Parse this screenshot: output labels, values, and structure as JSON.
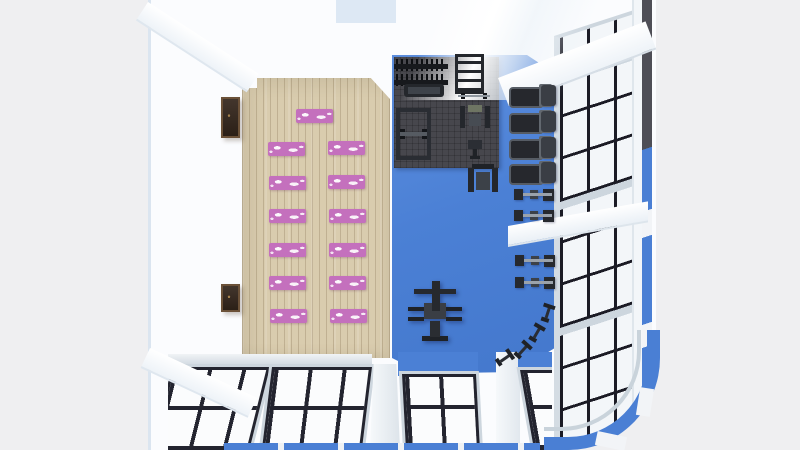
{
  "scene": {
    "title": "Top-down 3D render of a gym interior floor plan",
    "description": "Gym room viewed from above: wooden yoga zone on the left with pink patterned mats, blue cardio and strength zone on the right with a dark rubber free-weight mat, treadmills and ellipticals along a glazed wall, spin bikes in a curved glass corner, window walls with black mullions on the right and bottom, white walls and ceiling beams.",
    "colors": {
      "background": "#efeff1",
      "wall_white": "#fbfcfe",
      "wood_floor": "#d9ccae",
      "blue_floor": "#4b80d5",
      "rubber_mat": "#47474d",
      "yoga_mat_pink": "#c470bd",
      "window_mullion": "#1b1b25",
      "window_pane": "#f6f8fa",
      "window_frame_silver": "#cdd6de",
      "exterior_accent_blue": "#4a7fd4",
      "equipment_dark": "#26292e",
      "frame_brown": "#6b5138"
    },
    "zones": {
      "yoga_area": {
        "floor": "light wood planks",
        "mat_count": 13,
        "mat_layout": "1 instructor mat at front, then 6 rows of 2 mats"
      },
      "free_weight_area": {
        "floor": "dark rubber mat",
        "equipment": [
          "dumbbell rack",
          "storage rack",
          "flat bench",
          "power rack",
          "barbell",
          "shoulder press machine",
          "utility seat"
        ]
      },
      "cardio_area": {
        "floor": "blue",
        "treadmill_count": 4,
        "elliptical_count": 4,
        "spin_bike_count": 4,
        "other": [
          "cable crossover machine",
          "leg press machine"
        ]
      },
      "walls": {
        "wall_art_count": 2,
        "window_walls": [
          "right glazed wall with black grid",
          "bottom glazed wall with black grid",
          "curved glass corner bottom-right"
        ]
      }
    }
  },
  "objects": {
    "yoga_mats": {
      "positions": [
        [
          296,
          109
        ],
        [
          268,
          142
        ],
        [
          328,
          141
        ],
        [
          269,
          176
        ],
        [
          328,
          175
        ],
        [
          269,
          209
        ],
        [
          329,
          209
        ],
        [
          269,
          243
        ],
        [
          329,
          243
        ],
        [
          269,
          276
        ],
        [
          329,
          276
        ],
        [
          270,
          309
        ],
        [
          330,
          309
        ]
      ]
    },
    "treadmills": {
      "positions": [
        [
          509,
          85
        ],
        [
          509,
          111
        ],
        [
          509,
          137
        ],
        [
          509,
          162
        ]
      ]
    },
    "ellipticals": {
      "positions": [
        [
          512,
          187
        ],
        [
          512,
          208
        ],
        [
          513,
          253
        ],
        [
          513,
          275
        ]
      ]
    },
    "spin_bikes": {
      "positions": [
        [
          541,
          304
        ],
        [
          530,
          324
        ],
        [
          516,
          341
        ],
        [
          498,
          349
        ]
      ],
      "angles": [
        18,
        30,
        42,
        55
      ]
    },
    "items": [
      {
        "type": "db-rack",
        "x": 394,
        "y": 59
      },
      {
        "type": "flat-bench",
        "x": 404,
        "y": 84
      },
      {
        "type": "power-rack",
        "x": 396,
        "y": 108
      },
      {
        "type": "ladder-rack",
        "x": 455,
        "y": 54
      },
      {
        "type": "barbell",
        "x": 458,
        "y": 93
      },
      {
        "type": "shoulder-machine",
        "x": 460,
        "y": 104
      },
      {
        "type": "bench-seat",
        "x": 468,
        "y": 140
      },
      {
        "type": "leg-press",
        "x": 468,
        "y": 164
      },
      {
        "type": "cable-machine",
        "x": 408,
        "y": 281
      },
      {
        "type": "picture-frame",
        "x": 221,
        "y": 97,
        "w": 19,
        "h": 41
      },
      {
        "type": "picture-frame",
        "x": 221,
        "y": 284,
        "w": 19,
        "h": 28
      }
    ]
  }
}
